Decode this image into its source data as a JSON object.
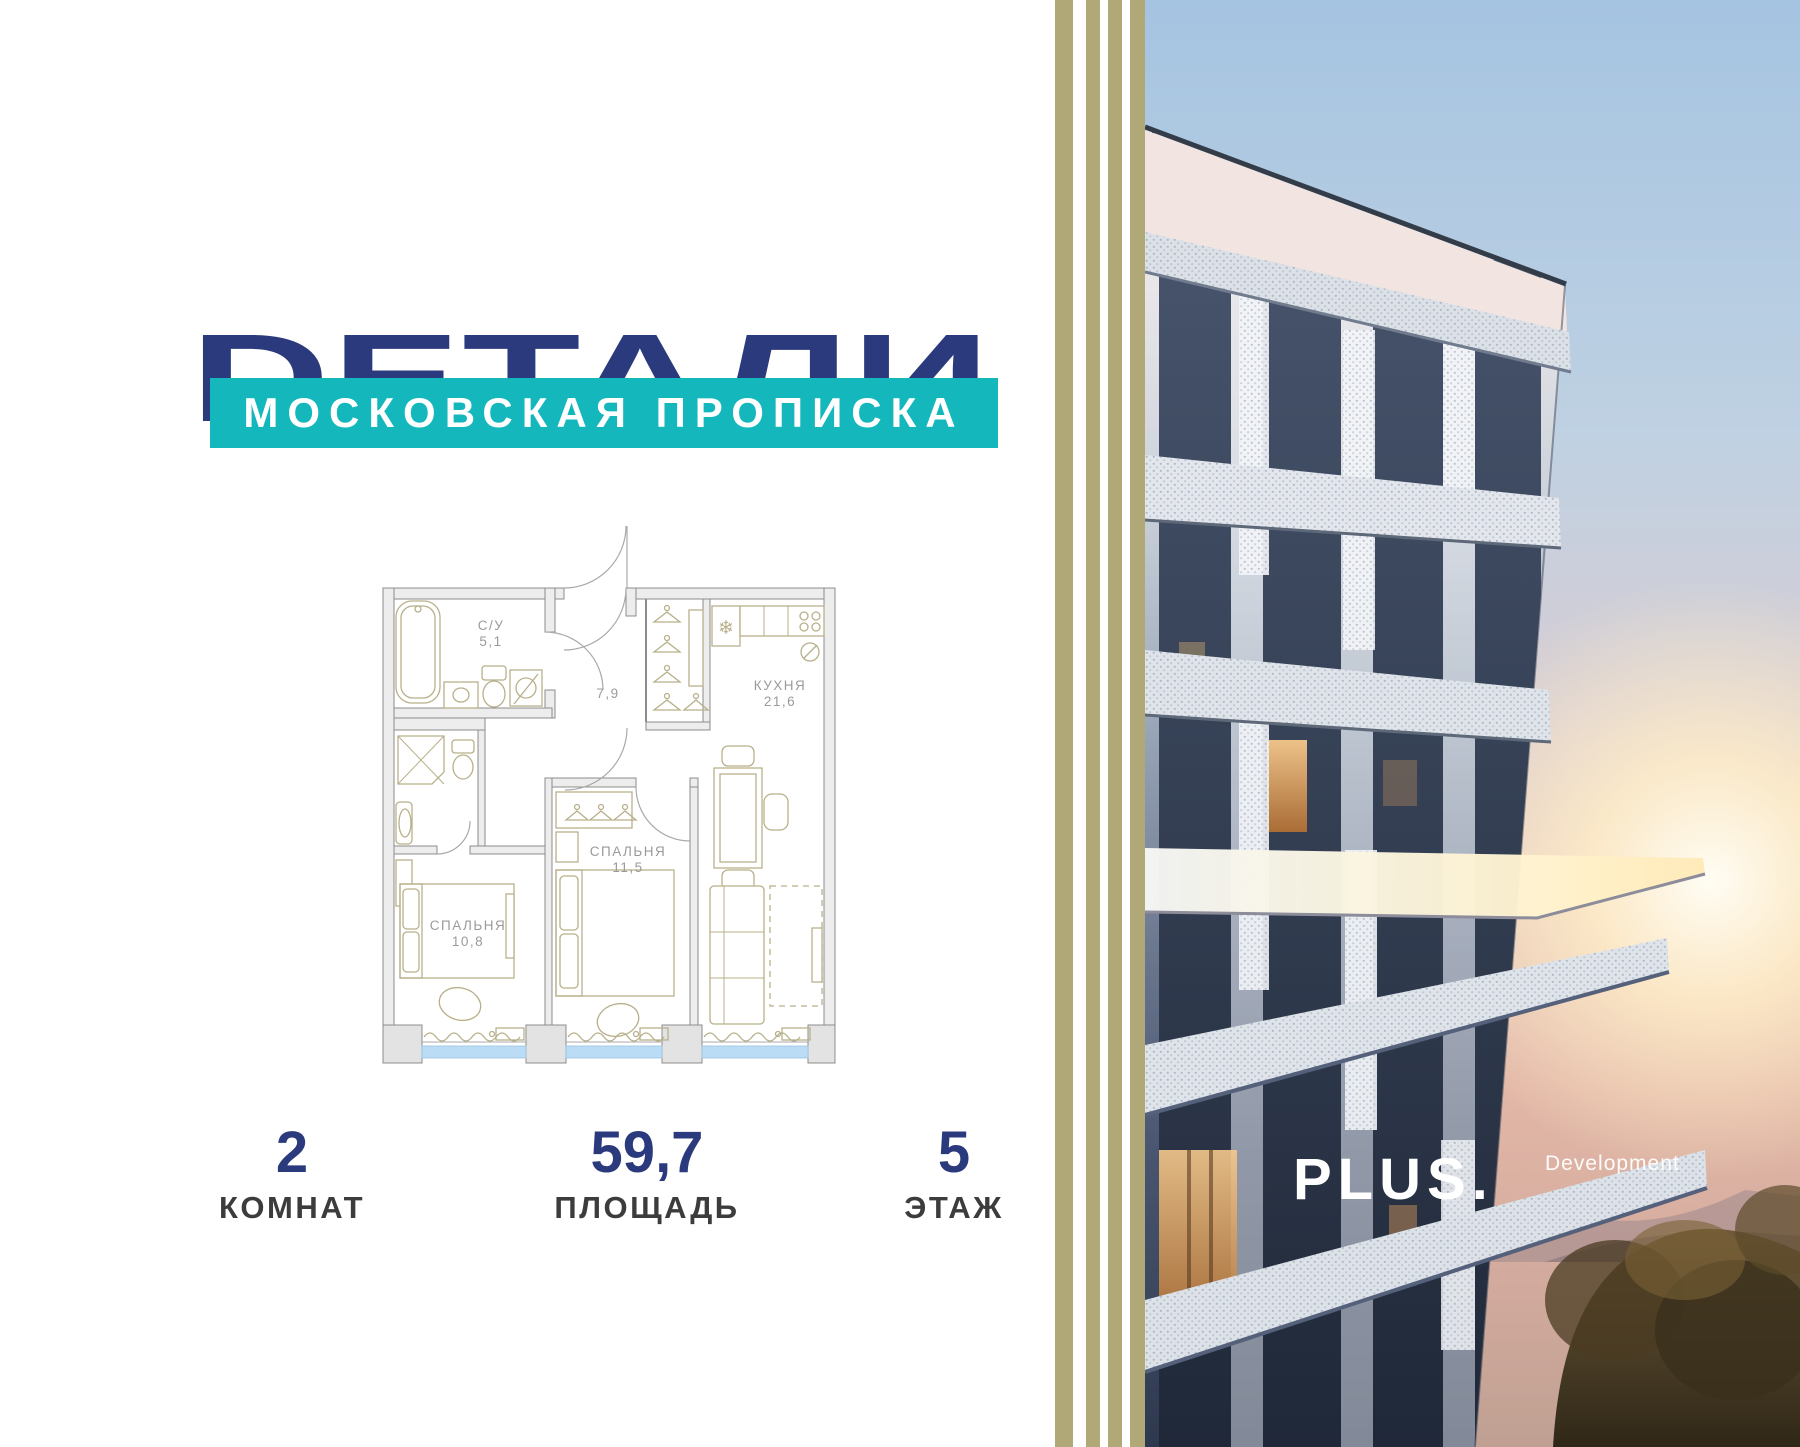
{
  "brand": {
    "title": "DЕТАЛИ",
    "subtitle": "МОСКОВСКАЯ ПРОПИСКА",
    "title_color": "#2b3a7d",
    "subtitle_bg": "#14b8bc"
  },
  "floor_plan": {
    "rooms": [
      {
        "name": "С/У",
        "area": "5,1"
      },
      {
        "name": "",
        "area": "7,9"
      },
      {
        "name": "КУХНЯ",
        "area": "21,6"
      },
      {
        "name": "СПАЛЬНЯ",
        "area": "11,5"
      },
      {
        "name": "СПАЛЬНЯ",
        "area": "10,8"
      }
    ]
  },
  "stats": [
    {
      "value": "2",
      "label": "КОМНАТ"
    },
    {
      "value": "59,7",
      "label": "ПЛОЩАДЬ"
    },
    {
      "value": "5",
      "label": "ЭТАЖ"
    }
  ],
  "developer": {
    "logo": "PLUS.",
    "logo_suffix": "Development"
  },
  "colors": {
    "accent_blue": "#2b3a7d",
    "teal": "#14b8bc",
    "stripe_khaki": "#b1a878",
    "plan_furniture": "#b8b08a",
    "plan_walls": "#8c8c8c",
    "window_glass": "#badcf5"
  }
}
